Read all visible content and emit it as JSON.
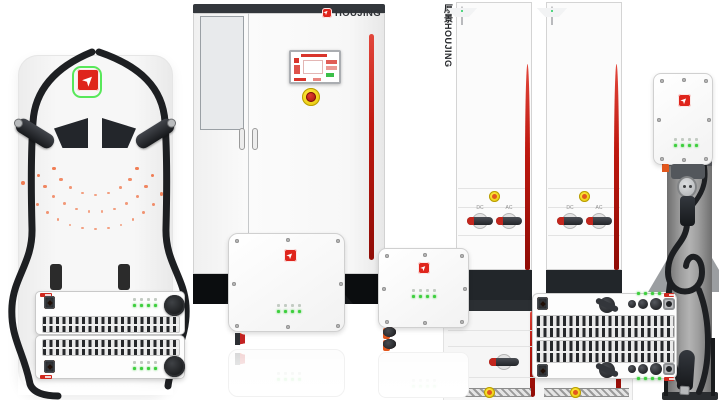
{
  "brand": {
    "name": "HOUJING",
    "vertical_name": "厚景HOUJING",
    "logo_glyph": "➤",
    "logo_red": "#df251c",
    "logo_green": "#58e85a"
  },
  "colors": {
    "stripe_red": "#c01910",
    "connector_orange": "#e2571d",
    "led_green": "#3ecf3e",
    "estop_yellow": "#f3d609",
    "dark_panel": "#1b1e22",
    "body_white": "#f7f7f7",
    "dot_orange": "#ef6230"
  },
  "racks": {
    "module_count": 9,
    "side_label": "厚景HOUJING",
    "switch_labels": [
      "DC",
      "AC"
    ]
  },
  "left_pile": {
    "dot_arcs": [
      {
        "r": 80,
        "count": 15
      },
      {
        "r": 63,
        "count": 12
      },
      {
        "r": 46,
        "count": 9
      }
    ]
  },
  "stack_modules": {
    "conn_pattern": [
      "or",
      "or",
      "or",
      "or",
      "gap",
      "or",
      "bk"
    ]
  },
  "wallbox1": {
    "conn_pattern": [
      "nub",
      "bar",
      "bar",
      "bar",
      "red",
      "bar",
      "bar",
      "bar",
      "red",
      "bar",
      "bar"
    ]
  },
  "wallbox2": {
    "row_pattern": [
      "nub",
      "rred",
      "rred",
      "rbk",
      "rbk",
      "rbk"
    ]
  },
  "wallbox3": {
    "nub_pattern": [
      "nub",
      "bar",
      "nub",
      "bar",
      "nub"
    ]
  },
  "wide_module": {
    "conn_pattern": [
      "or",
      "bk",
      "gap",
      "or",
      "bk"
    ]
  }
}
